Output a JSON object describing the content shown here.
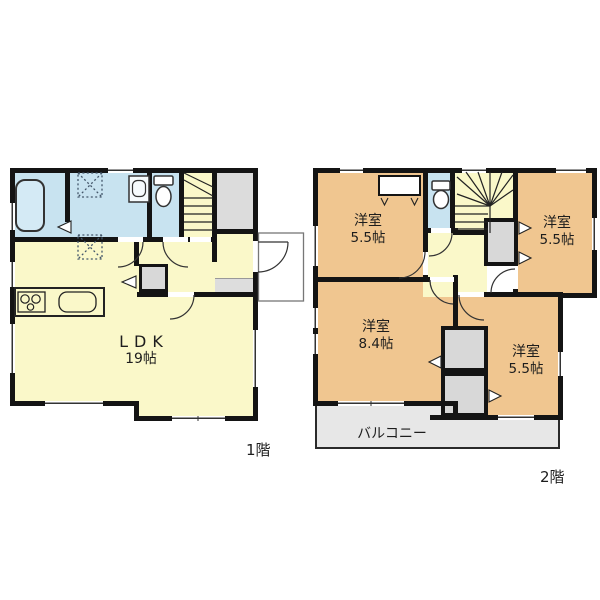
{
  "colors": {
    "wall": "#141414",
    "room_yellow": "#faf8c9",
    "room_blue": "#c8e3f0",
    "room_orange": "#f0c690",
    "closet_gray": "#d8d8d8",
    "entrance_gray": "#dcdcdc",
    "genkan_gray": "#dddddd",
    "balcony_gray": "#e7e7e7",
    "fixture_line": "#333333"
  },
  "floor1": {
    "floor_label": "1階",
    "ldk": {
      "name": "LDK",
      "size": "19帖"
    }
  },
  "floor2": {
    "floor_label": "2階",
    "room_top_left": {
      "name": "洋室",
      "size": "5.5帖"
    },
    "room_top_right": {
      "name": "洋室",
      "size": "5.5帖"
    },
    "room_bottom_left": {
      "name": "洋室",
      "size": "8.4帖"
    },
    "room_bottom_right": {
      "name": "洋室",
      "size": "5.5帖"
    },
    "balcony": {
      "name": "バルコニー"
    }
  },
  "icons": {
    "bathtub-icon": "rounded-rect outline",
    "washbasin-icon": "rect with bowl",
    "toilet-icon": "tank + oval bowl",
    "washing-machine-pad-icon": "dotted square with X",
    "stairs-icon": "treads + winder fan lines",
    "door-arc-icon": "quarter-circle swing",
    "closet-door-icon": "small triangle marker",
    "window-icon": "white wall gap with thin line",
    "kitchen-stove-icon": "3 burner circles",
    "kitchen-sink-icon": "rounded rectangle"
  }
}
